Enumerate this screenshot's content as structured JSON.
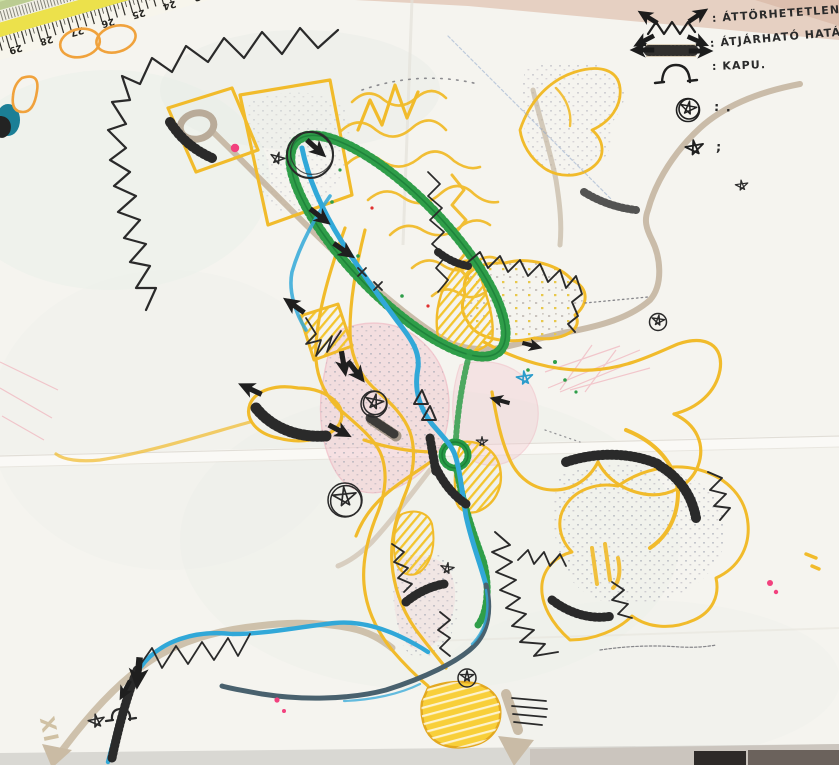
{
  "document": {
    "kind": "hand-drawn urban planning sketch on folded tracing paper",
    "language": "hu"
  },
  "legend": {
    "items": [
      {
        "symbol": "impenetrable-border-symbol",
        "label": ": ÁTTÖRHETETLEN HATÁR"
      },
      {
        "symbol": "permeable-border-symbol",
        "label": ": ÁTJÁRHATÓ HATÁR"
      },
      {
        "symbol": "gate-symbol",
        "label": ": KAPU."
      },
      {
        "symbol": "circled-star-symbol",
        "label": ": ."
      },
      {
        "symbol": "star-symbol",
        "label": ";"
      }
    ]
  },
  "ruler": {
    "numbers": [
      "29",
      "28",
      "27",
      "26",
      "25",
      "24",
      "23"
    ]
  },
  "map": {
    "roman_mark": "XI",
    "features": [
      "river-blue",
      "stream-blue-hatched",
      "green-loop-band",
      "green-roundabout",
      "yellow-road-network",
      "yellow-terraces",
      "settlement-pink-areas",
      "tan-roads",
      "impenetrable-zigzag-borders",
      "permeable-tick-borders",
      "gate-marks",
      "circled-star-markers",
      "star-markers"
    ]
  },
  "colors": {
    "ink": "#262626",
    "yellow_marker": "#f1bb2b",
    "green_marker": "#2f9e49",
    "blue_marker": "#31a8d8",
    "navy_marker": "#49616e",
    "tan_road": "#c2b19c",
    "pink_settlement": "#f3c9d0",
    "magenta_dot": "#f2417e",
    "paper": "#f5f4ef"
  }
}
